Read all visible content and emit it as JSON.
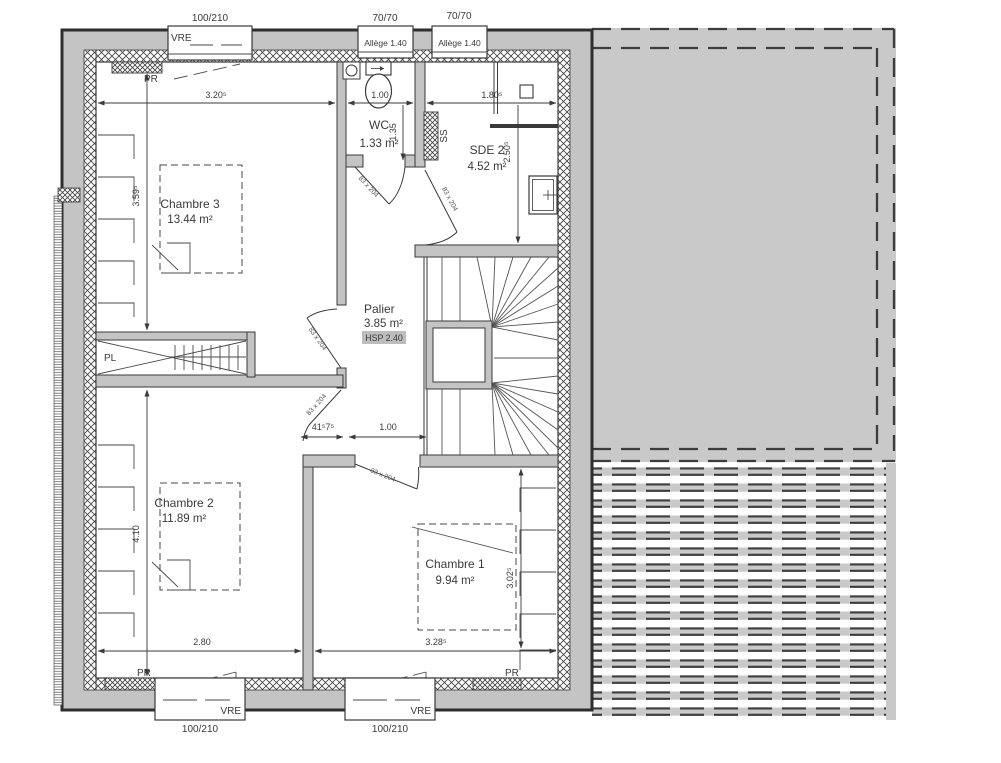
{
  "plan": {
    "windows": {
      "vre": "VRE",
      "vre_size": "100/210",
      "small_size": "70/70",
      "allege": "Allège 1.40"
    },
    "rooms": {
      "chambre3": {
        "name": "Chambre 3",
        "area": "13.44 m²"
      },
      "wc": {
        "name": "WC",
        "area": "1.33 m²"
      },
      "sde2": {
        "name": "SDE 2",
        "area": "4.52 m²"
      },
      "palier": {
        "name": "Palier",
        "area": "3.85 m²",
        "ceiling": "HSP 2.40"
      },
      "chambre2": {
        "name": "Chambre 2",
        "area": "11.89 m²"
      },
      "chambre1": {
        "name": "Chambre 1",
        "area": "9.94 m²"
      },
      "closet": "PL"
    },
    "marks": {
      "radiator": "PR",
      "duct": "SS",
      "door_size": "83 x 204"
    },
    "dims": {
      "ch3_w": "3.20⁵",
      "wc_w": "1.00",
      "sde2_w": "1.80⁵",
      "wc_h": "1.35",
      "sde2_h": "2.50⁵",
      "ch3_h": "3.59⁵",
      "ch2_h": "4.10",
      "ch2_w": "2.80",
      "ch1_w": "3.28⁵",
      "ch1_h": "3.02⁵",
      "palier_s": "41⁵7⁵",
      "palier_d": "1.00"
    },
    "colors": {
      "wall": "#c4c4c4",
      "roof": "#c9c9c9",
      "line": "#3a3a3a",
      "highlight": "#bdbdbd"
    }
  }
}
